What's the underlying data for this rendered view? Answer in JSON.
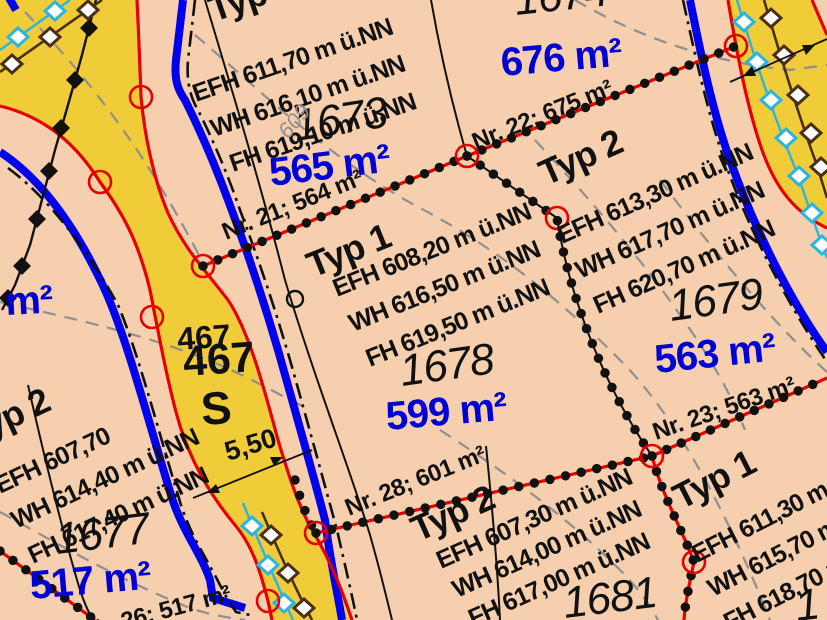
{
  "colors": {
    "parcel_fill": "#f6cfae",
    "road_fill": "#f0cc39",
    "boundary_red": "#e60000",
    "line_blue": "#0000ee",
    "area_text_blue": "#0000d4",
    "contour_gray": "#8f8f8f",
    "utility_cyan": "#2ab5e0",
    "utility_brown": "#4a2f17"
  },
  "parcels": {
    "p1673": {
      "type": "Typ 2",
      "efh": "EFH 611,70 m ü.NN",
      "wh": "WH 616,10 m ü.NN",
      "fh": "FH 619,10 m ü.NN",
      "number": "1673",
      "area": "565 m²"
    },
    "p1674": {
      "number": "1674",
      "area": "676 m²"
    },
    "p1678": {
      "type": "Typ 1",
      "efh": "EFH 608,20 m ü.NN",
      "wh": "WH 616,50 m ü.NN",
      "fh": "FH 619,50 m ü.NN",
      "number": "1678",
      "area": "599 m²"
    },
    "p1679": {
      "type": "Typ 2",
      "efh": "EFH 613,30 m ü.NN",
      "wh": "WH 617,70 m ü.NN",
      "fh": "FH 620,70 m ü.NN",
      "number": "1679",
      "area": "563 m²"
    },
    "p1677": {
      "type": "Typ 2",
      "efh": "EFH 607,70",
      "wh": "WH 614,40 m ü.NN",
      "fh": "FH 617,40 m ü.NN",
      "number": "1677",
      "area": "517 m²"
    },
    "p1681": {
      "type": "Typ 2",
      "efh": "EFH 607,30 m ü.NN",
      "wh": "WH 614,00 m ü.NN",
      "fh": "FH 617,00 m ü.NN",
      "number": "1681"
    },
    "p_right": {
      "type": "Typ 1",
      "efh": "EFH 611,30 m ü.NN",
      "wh": "WH 615,70 m ü.NN",
      "fh": "FH 618,70 m ü.NN",
      "number": "1"
    }
  },
  "lot_labels": {
    "nr21": "Nr. 21; 564 m²",
    "nr22": "Nr. 22; 675 m²",
    "nr23": "Nr. 23; 563 m²",
    "nr28": "Nr. 28; 601 m²",
    "nr26": "Nr. 26; 517 m²"
  },
  "road": {
    "number": "467",
    "number_large": "467",
    "letter": "S",
    "width_dim": "5,50"
  },
  "misc": {
    "contour": "609",
    "partial_area": "m²"
  }
}
